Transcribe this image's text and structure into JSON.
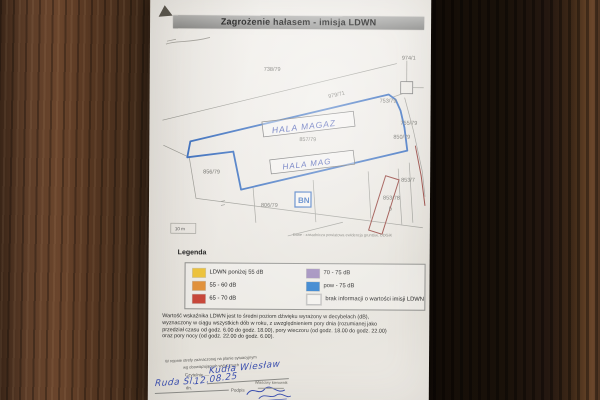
{
  "title_bar": "Zagrożenie hałasem - imisja LDWN",
  "map": {
    "labels": [
      "738/79",
      "974/1",
      "979/71",
      "753/79",
      "755/79",
      "850/79",
      "857/79",
      "856/79",
      "806/79",
      "853/7",
      "853/78",
      "b"
    ],
    "hall_upper": "HALA MAGAZ",
    "hall_lower": "HALA MAG",
    "bn_box": "BN",
    "scale_label": "10 m",
    "source_caption": "Dane - zasadnicza powiatowa ewidencja gruntów, ODGiK"
  },
  "legend": {
    "title": "Legenda",
    "left_items": [
      {
        "label": "LDWN poniżej 55 dB",
        "color": "#eec43d"
      },
      {
        "label": "55 - 60 dB",
        "color": "#e2923c"
      },
      {
        "label": "65 - 70 dB",
        "color": "#c8473a"
      }
    ],
    "right_items": [
      {
        "label": "70 - 75 dB",
        "color": "#9b87b9"
      },
      {
        "label": "pow - 75 dB",
        "color": "#2b7ccc"
      },
      {
        "label": "brak informacji o wartości imisji LDWN",
        "color": "#f3f1ed"
      }
    ]
  },
  "description_lines": [
    "Wartość wskaźnika LDWN jest to średni poziom dźwięku wyrażony w decybelach (dB),",
    "wyznaczony w ciągu wszystkich dób w roku, z uwzględnieniem pory dnia (rozumianej jako",
    "przedział czasu od godz. 6.00 do godz. 18.00), pory wieczoru (od godz. 18.00 do godz. 22.00)",
    "oraz pory nocy (od godz. 22.00 do godz. 6.00)."
  ],
  "footer_form": {
    "note_line1": "W rejonie strefy zaznaczonej na planie sytuacyjnym",
    "note_line2": "wg obowiązujących wytycznych",
    "name_label": "Czytelnie —",
    "name_value": "Kudła Wiesław",
    "place_value": "Ruda Śl.",
    "date_label": "dn.",
    "date_value": "12.08.25",
    "signature_label": "Podpis",
    "approver_line": "Właściwy kierownik"
  },
  "colors": {
    "boundary_blue": "#3a6fc0",
    "building_red": "#93403a",
    "handwriting_ink": "#3b4fae",
    "title_bar_gray": "#9c9c9a"
  }
}
